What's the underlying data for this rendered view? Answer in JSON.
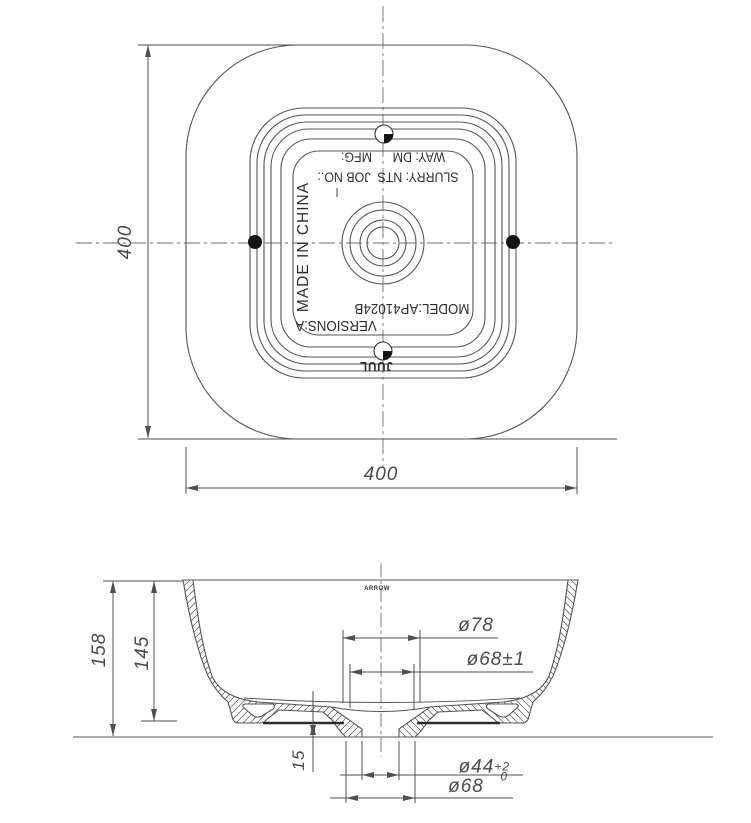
{
  "top_view": {
    "dim_width": "400",
    "dim_height": "400",
    "stamp_line1": "WAY: DM      MFG:",
    "stamp_line2": "SLURRY: NTS  JOB NO.:",
    "stamp_origin": "MADE IN CHINA",
    "stamp_model": "MODEL:AP41024B",
    "stamp_version": "VERSIONS:A",
    "stamp_logo": "JUUL"
  },
  "section_view": {
    "brand": "ARROW",
    "dim_overall_height": "158",
    "dim_inner_height": "145",
    "dim_drain_height": "15",
    "dim_top_diameter": "ø78",
    "dim_mid_diameter": "ø68±1",
    "dim_drain_diameter": "ø44",
    "dim_drain_tol_upper": "+2",
    "dim_drain_tol_lower": "0",
    "dim_outlet_diameter": "ø68"
  },
  "colors": {
    "line": "#4f4f4f",
    "text": "#3d3d3d",
    "fill_marker": "#141414",
    "background": "#ffffff"
  }
}
